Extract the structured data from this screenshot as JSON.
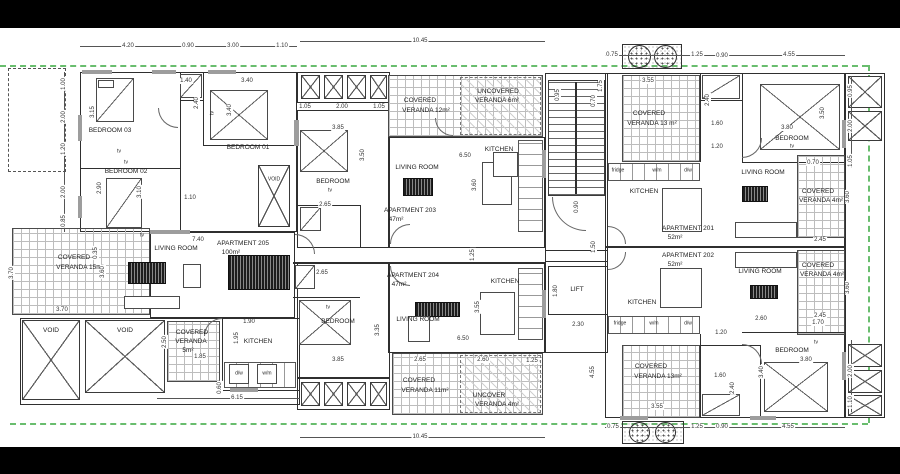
{
  "meta": {
    "paper_color": "#ffffff",
    "bar_color": "#000000",
    "wall_color": "#2f2f2f",
    "boundary_color": "#69bd6e"
  },
  "drawing": {
    "apartments": {
      "a201": {
        "name": "APARTMENT 201",
        "area": "52m²"
      },
      "a202": {
        "name": "APARTMENT 202",
        "area": "52m²"
      },
      "a203": {
        "name": "APARTMENT 203",
        "area": "47m²"
      },
      "a204": {
        "name": "APARTMENT 204",
        "area": "47m²"
      },
      "a205": {
        "name": "APARTMENT 205",
        "area": "100m²"
      }
    },
    "rooms": {
      "bedroom01": "BEDROOM 01",
      "bedroom02": "BEDROOM 02",
      "bedroom03": "BEDROOM 03",
      "bedroom": "BEDROOM",
      "living_room": "LIVING ROOM",
      "kitchen": "KITCHEN",
      "lift": "LIFT",
      "void": "VOID",
      "tv": "tv"
    },
    "verandas": {
      "covered_15": {
        "l1": "COVERED",
        "l2": "VERANDA 15m²"
      },
      "covered_12": {
        "l1": "COVERED",
        "l2": "VERANDA 12m²"
      },
      "uncovered_6": {
        "l1": "UNCOVERED",
        "l2": "VERANDA 6m²"
      },
      "covered_13_top": {
        "l1": "COVERED",
        "l2": "VERANDA 13 m²"
      },
      "covered_5": {
        "l1": "COVERED",
        "l2": "VERANDA",
        "l3": "5m²"
      },
      "covered_11": {
        "l1": "COVERED",
        "l2": "VERANDA 11m²"
      },
      "uncovered_4": {
        "l1": "UNCOVER",
        "l2": "VERANDA 4m²"
      },
      "covered_4_top": {
        "l1": "COVERED",
        "l2": "VERANDA 4m²"
      },
      "covered_4_bottom": {
        "l1": "COVERED",
        "l2": "VERANDA 4m²"
      },
      "covered_13_bottom": {
        "l1": "COVERED",
        "l2": "VERANDA 13m²"
      }
    },
    "appliances": {
      "fridge": "fridge",
      "wm": "w/m",
      "dw": "d/w"
    },
    "dims": {
      "d035": "0.35",
      "d060": "0.60",
      "d070": "0.70",
      "d075": "0.75",
      "d085": "0.85",
      "d090": "0.90",
      "d095": "0.95",
      "d100": "1.00",
      "d105": "1.05",
      "d110": "1.10",
      "d120": "1.20",
      "d125": "1.25",
      "d140": "1.40",
      "d150": "1.50",
      "d160": "1.60",
      "d170": "1.70",
      "d175": "1.75",
      "d180": "1.80",
      "d185": "1.85",
      "d190": "1.90",
      "d195": "1.95",
      "d200": "2.00",
      "d230": "2.30",
      "d240": "2.40",
      "d245": "2.45",
      "d250": "2.50",
      "d260": "2.60",
      "d265": "2.65",
      "d290": "2.90",
      "d300": "3.00",
      "d310": "3.10",
      "d315": "3.15",
      "d335": "3.35",
      "d340": "3.40",
      "d350": "3.50",
      "d355": "3.55",
      "d360": "3.60",
      "d370": "3.70",
      "d380": "3.80",
      "d385": "3.85",
      "d420": "4.20",
      "d455": "4.55",
      "d615": "6.15",
      "d650": "6.50",
      "d740": "7.40",
      "d1045": "10.45"
    }
  }
}
